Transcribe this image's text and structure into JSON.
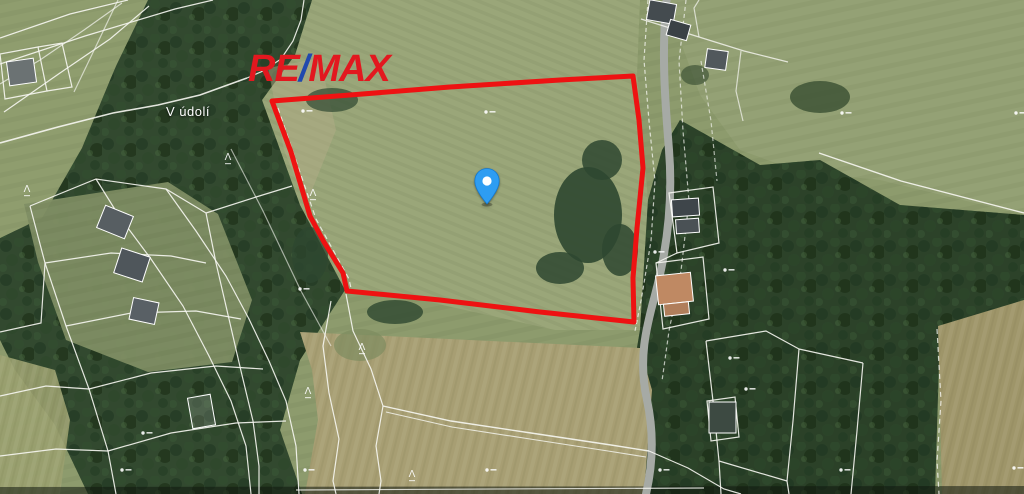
{
  "brand": {
    "re": "RE",
    "slash": "/",
    "max": "MAX",
    "red": "#e2181f",
    "blue": "#2149ae"
  },
  "labels": {
    "street": "V údolí"
  },
  "pin": {
    "transform": "translate(474,168)",
    "color": "#2e9df2",
    "inner": "#ffffff",
    "border": "#1478cf"
  },
  "boundary": {
    "color": "#ee1212",
    "width": 5,
    "points": "272,101 350,95 450,87 560,80 633,76 639,120 643,168 637,228 633,278 634,322 540,312 440,300 347,291 343,273 324,242 310,216 291,152"
  },
  "map": {
    "line_color": "#f7f7f2",
    "tree_glyph": "Λ",
    "terrain": [
      {
        "n": "field-base",
        "pts": "0,0 1024,0 1024,494 0,494",
        "f": "#8d9b6d",
        "tex": "stripesC"
      },
      {
        "n": "field-north-east",
        "pts": "636,0 1024,0 1024,215 880,180 800,172 740,150 700,95 680,40 668,0",
        "f": "#94a175",
        "tex": "stripesC"
      },
      {
        "n": "property-field",
        "pts": "310,0 640,0 637,75 648,200 640,330 555,330 420,300 345,290 300,205 262,100 292,55",
        "f": "#9aa679",
        "tex": "stripesA"
      },
      {
        "n": "forest-west",
        "pts": "145,0 312,0 295,55 262,100 300,205 345,290 300,360 280,430 302,494 88,494 55,425 15,370 0,340 0,238 42,218 82,148 115,68",
        "f": "#32492f",
        "tex": "trees"
      },
      {
        "n": "meadow-north-west",
        "pts": "0,0 148,0 116,66 80,150 40,218 0,238",
        "f": "#8f9d6e",
        "tex": "stripesC"
      },
      {
        "n": "meadow-west",
        "pts": "24,204 168,182 218,214 252,300 232,362 148,372 66,340 38,262",
        "f": "#7f8e64",
        "o": 0.95,
        "tex": "stripesC"
      },
      {
        "n": "meadow-south-west",
        "pts": "0,355 55,370 70,420 60,494 0,494",
        "f": "#9aa06f",
        "o": 0.9,
        "tex": "stripesB"
      },
      {
        "n": "forest-east",
        "pts": "680,120 760,165 820,160 900,205 1024,215 1024,300 940,330 640,330 648,200 662,150",
        "f": "#2c4229",
        "tex": "trees"
      },
      {
        "n": "forest-south-east",
        "pts": "640,330 940,330 935,494 640,494 628,400",
        "f": "#2b4128",
        "tex": "trees"
      },
      {
        "n": "field-south",
        "pts": "300,332 640,348 652,390 644,494 305,494 318,420 312,370",
        "f": "#a79e73",
        "tex": "stripesB"
      },
      {
        "n": "field-far-east",
        "pts": "938,326 1024,300 1024,494 942,494",
        "f": "#9e9569",
        "tex": "stripesB"
      },
      {
        "n": "dirt-strip",
        "pts": "268,68 320,58 336,130 306,205 284,150",
        "f": "#b5ad8a",
        "o": 0.45
      },
      {
        "n": "bottom-shade",
        "pts": "0,487 1024,486 1024,494 0,494",
        "f": "#10180f",
        "o": 0.55
      }
    ],
    "blobs": [
      [
        588,
        215,
        34,
        48,
        0.9,
        "#2e4730"
      ],
      [
        602,
        160,
        20,
        20,
        0.85,
        "#2e4730"
      ],
      [
        560,
        268,
        24,
        16,
        0.85,
        "#2e4730"
      ],
      [
        620,
        250,
        18,
        26,
        0.85,
        "#2e4730"
      ],
      [
        332,
        100,
        26,
        12,
        0.7,
        "#2e4730"
      ],
      [
        395,
        312,
        28,
        12,
        0.8,
        "#2e4730"
      ],
      [
        820,
        97,
        30,
        16,
        0.75,
        "#33492e"
      ],
      [
        310,
        255,
        18,
        28,
        0.75,
        "#2e4730"
      ],
      [
        695,
        75,
        14,
        10,
        0.6,
        "#33492e"
      ],
      [
        360,
        345,
        26,
        16,
        0.7,
        "#7d8c60"
      ]
    ],
    "roads": [
      {
        "d": "M667,-4 C661,50 665,100 669,150 C673,200 667,250 655,295 C646,328 638,360 647,400 C655,437 652,468 646,494",
        "c": "#a6aaa5",
        "w": 8
      }
    ],
    "lines": [
      {
        "d": "M0,38 L70,14 L128,0"
      },
      {
        "d": "M0,64 L85,36 L175,9 L213,0"
      },
      {
        "d": "M4,112 L60,73 L110,39 L149,6"
      },
      {
        "d": "M0,84 L40,60 L84,30 L122,3",
        "o": 0.7
      },
      {
        "d": "M118,0 L98,42 L74,92",
        "o": 0.65
      },
      {
        "d": "M0,143 L58,127 L113,113 L158,105 L200,95 L247,78",
        "w": 1.6
      },
      {
        "d": "M247,78 L263,71 L281,59 L293,41 L301,20 L304,0"
      },
      {
        "d": "M0,54 L38,47 L47,91 L5,99 Z"
      },
      {
        "d": "M38,47 L62,43 L72,87 L47,91"
      },
      {
        "d": "M278,108 L316,219 L349,279 L352,293",
        "da": "5,4",
        "o": 0.8
      },
      {
        "d": "M231,149 L263,211 L301,291 L331,346",
        "o": 0.6
      },
      {
        "d": "M30,206 L96,179 L166,189 L206,213"
      },
      {
        "d": "M206,213 L256,197 L292,186"
      },
      {
        "d": "M30,206 L45,263 L66,326 L89,389 L108,451 L116,494"
      },
      {
        "d": "M96,179 L119,216 L151,259 L183,306 L209,356 L231,401 L246,446 L251,494"
      },
      {
        "d": "M166,189 L196,231 L226,276 L249,319 L269,361 L286,401 L296,446 L299,494"
      },
      {
        "d": "M45,263 L111,253 L171,256 L206,263"
      },
      {
        "d": "M66,326 L131,313 L196,311 L241,319"
      },
      {
        "d": "M89,389 L151,373 L216,366 L263,369"
      },
      {
        "d": "M108,451 L171,433 L236,423 L286,421"
      },
      {
        "d": "M206,213 L216,263 L229,319 L241,371 L253,421 L259,466 L259,494"
      },
      {
        "d": "M0,332 L41,323 L45,263"
      },
      {
        "d": "M0,396 L46,386 L89,389"
      },
      {
        "d": "M0,456 L56,449 L108,451"
      },
      {
        "d": "M346,294 L353,331 L371,369 L383,406"
      },
      {
        "d": "M383,406 L451,421 L531,433 L611,445 L649,451",
        "w": 1.4
      },
      {
        "d": "M386,412 L452,427 L530,439 L608,451 L646,457",
        "w": 1.1,
        "o": 0.8
      },
      {
        "d": "M331,301 L323,346 L329,393 L339,439 L333,481 L336,494"
      },
      {
        "d": "M383,406 L376,446 L381,481 L379,494"
      },
      {
        "d": "M649,451 L688,468 L724,489 L741,494"
      },
      {
        "d": "M648,0 L644,60 L649,121 L655,181 L651,241 L641,301 L635,331",
        "da": "4,3",
        "o": 0.75
      },
      {
        "d": "M686,0 L679,61 L683,131 L689,201 L681,271 L669,331 L662,381",
        "da": "4,3",
        "o": 0.7
      },
      {
        "d": "M669,193 L713,187 L719,243 L677,253 Z"
      },
      {
        "d": "M656,263 L703,257 L709,319 L663,329 Z"
      },
      {
        "d": "M677,253 L656,263"
      },
      {
        "d": "M706,341 L766,331 L799,349"
      },
      {
        "d": "M799,349 L863,363"
      },
      {
        "d": "M799,349 L793,421 L787,481 L789,494"
      },
      {
        "d": "M863,363 L857,431 L851,494"
      },
      {
        "d": "M706,341 L713,401 L719,461 L721,494"
      },
      {
        "d": "M719,461 L787,481"
      },
      {
        "d": "M707,401 L735,397 L739,437 L711,441 Z"
      },
      {
        "d": "M937,329 L941,401 L937,461 L939,494",
        "da": "5,4",
        "o": 0.8
      },
      {
        "d": "M819,153 L901,181 L1024,213",
        "w": 1.4
      },
      {
        "d": "M641,19 L699,37 L744,51 L788,62",
        "o": 0.8
      },
      {
        "d": "M699,37 L694,8 L699,0",
        "o": 0.7
      },
      {
        "d": "M741,51 L736,91 L743,121",
        "o": 0.7
      },
      {
        "d": "M701,61 L711,121 L717,181",
        "da": "4,3",
        "o": 0.65
      },
      {
        "d": "M296,490 L704,488",
        "o": 0.8
      }
    ],
    "houses": [
      [
        8,
        60,
        27,
        24,
        -8,
        "#6b7273"
      ],
      [
        100,
        210,
        30,
        24,
        22,
        "#575e62"
      ],
      [
        117,
        252,
        30,
        26,
        18,
        "#4f565b"
      ],
      [
        131,
        300,
        26,
        22,
        12,
        "#596065"
      ],
      [
        672,
        199,
        27,
        17,
        -4,
        "#3e454a"
      ],
      [
        676,
        219,
        23,
        14,
        -4,
        "#4a5155"
      ],
      [
        657,
        274,
        35,
        29,
        -6,
        "#bf8963"
      ],
      [
        664,
        303,
        25,
        12,
        -6,
        "#b07e5b"
      ],
      [
        648,
        2,
        27,
        20,
        10,
        "#444b4f"
      ],
      [
        668,
        22,
        21,
        16,
        16,
        "#3a4145"
      ],
      [
        706,
        50,
        21,
        19,
        8,
        "#51585c"
      ],
      [
        709,
        402,
        27,
        31,
        0,
        "#3d4a42"
      ],
      [
        190,
        396,
        23,
        31,
        -10,
        "rgba(255,255,255,0.14)"
      ]
    ],
    "trees": [
      [
        228,
        160
      ],
      [
        313,
        196
      ],
      [
        362,
        350
      ],
      [
        308,
        394
      ],
      [
        412,
        477
      ],
      [
        27,
        192
      ]
    ],
    "markers": [
      [
        303,
        111
      ],
      [
        486,
        112
      ],
      [
        300,
        289
      ],
      [
        487,
        470
      ],
      [
        842,
        113
      ],
      [
        1016,
        113
      ],
      [
        655,
        252
      ],
      [
        725,
        270
      ],
      [
        730,
        358
      ],
      [
        746,
        389
      ],
      [
        841,
        470
      ],
      [
        660,
        470
      ],
      [
        1014,
        468
      ],
      [
        122,
        470
      ],
      [
        305,
        470
      ],
      [
        143,
        433
      ]
    ]
  }
}
